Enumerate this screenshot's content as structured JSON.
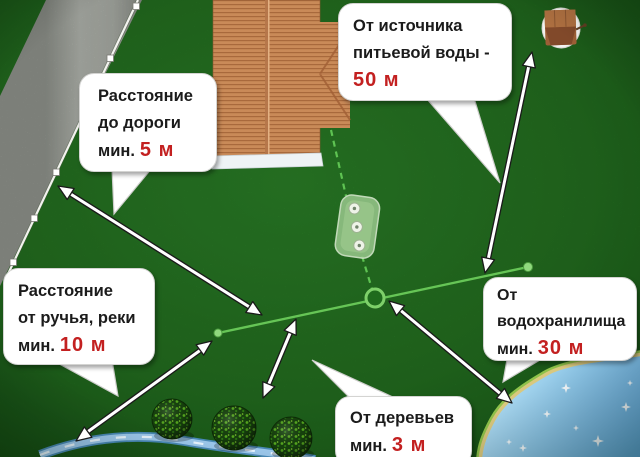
{
  "callouts": {
    "road": {
      "line1": "Расстояние",
      "line2": "до дороги",
      "prefix": "мин.",
      "value": "5 м"
    },
    "drinking_water": {
      "line1": "От источника",
      "line2": "питьевой воды -",
      "value": "50 м"
    },
    "stream": {
      "line1": "Расстояние",
      "line2": "от ручья, реки",
      "prefix": "мин.",
      "value": "10 м"
    },
    "reservoir": {
      "line1": "От",
      "line2": "водохранилища",
      "prefix": "мин.",
      "value": "30 м"
    },
    "trees": {
      "line1": "От деревьев",
      "prefix": "мин.",
      "value": "3 м"
    }
  },
  "colors": {
    "value_red": "#c32020",
    "text": "#1b1b1b",
    "bubble_bg": "#ffffff",
    "grass": "#277a23",
    "road_gray": "#bcc0b8",
    "roof_brown": "#c98a58",
    "pipe_green": "#66c556",
    "water_blue": "#8cc6e8"
  }
}
